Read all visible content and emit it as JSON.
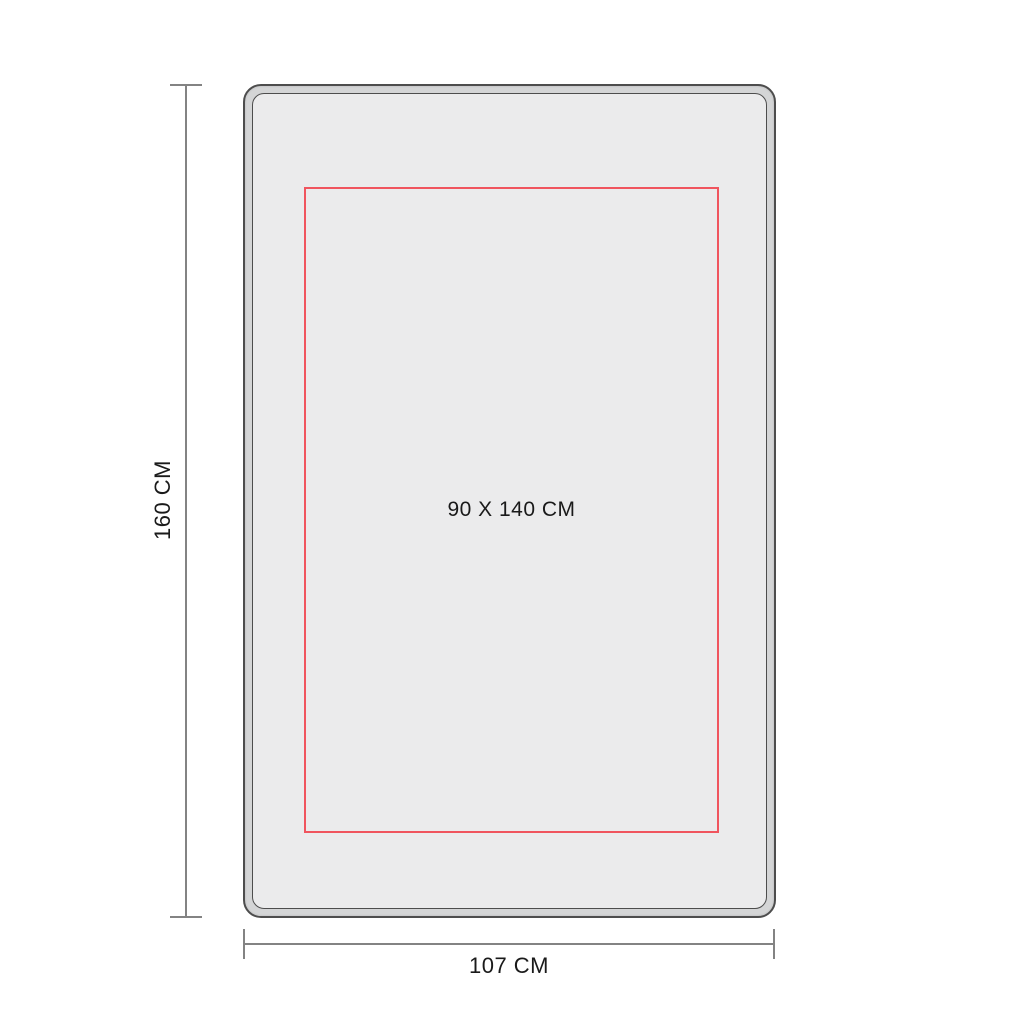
{
  "diagram": {
    "title": "panel-dimension-drawing",
    "board": {
      "print_area_label": "90 X 140 CM"
    },
    "height_dimension": {
      "label": "160 CM"
    },
    "width_dimension": {
      "label": "107 CM"
    },
    "colors": {
      "background": "#ffffff",
      "frame_border": "#4d4d4d",
      "frame_rim_fill": "#d4d5d6",
      "frame_face_fill": "#ebebec",
      "print_area_outline": "#f0545e",
      "dimension_line": "#838383",
      "text": "#1a1a1a"
    }
  }
}
